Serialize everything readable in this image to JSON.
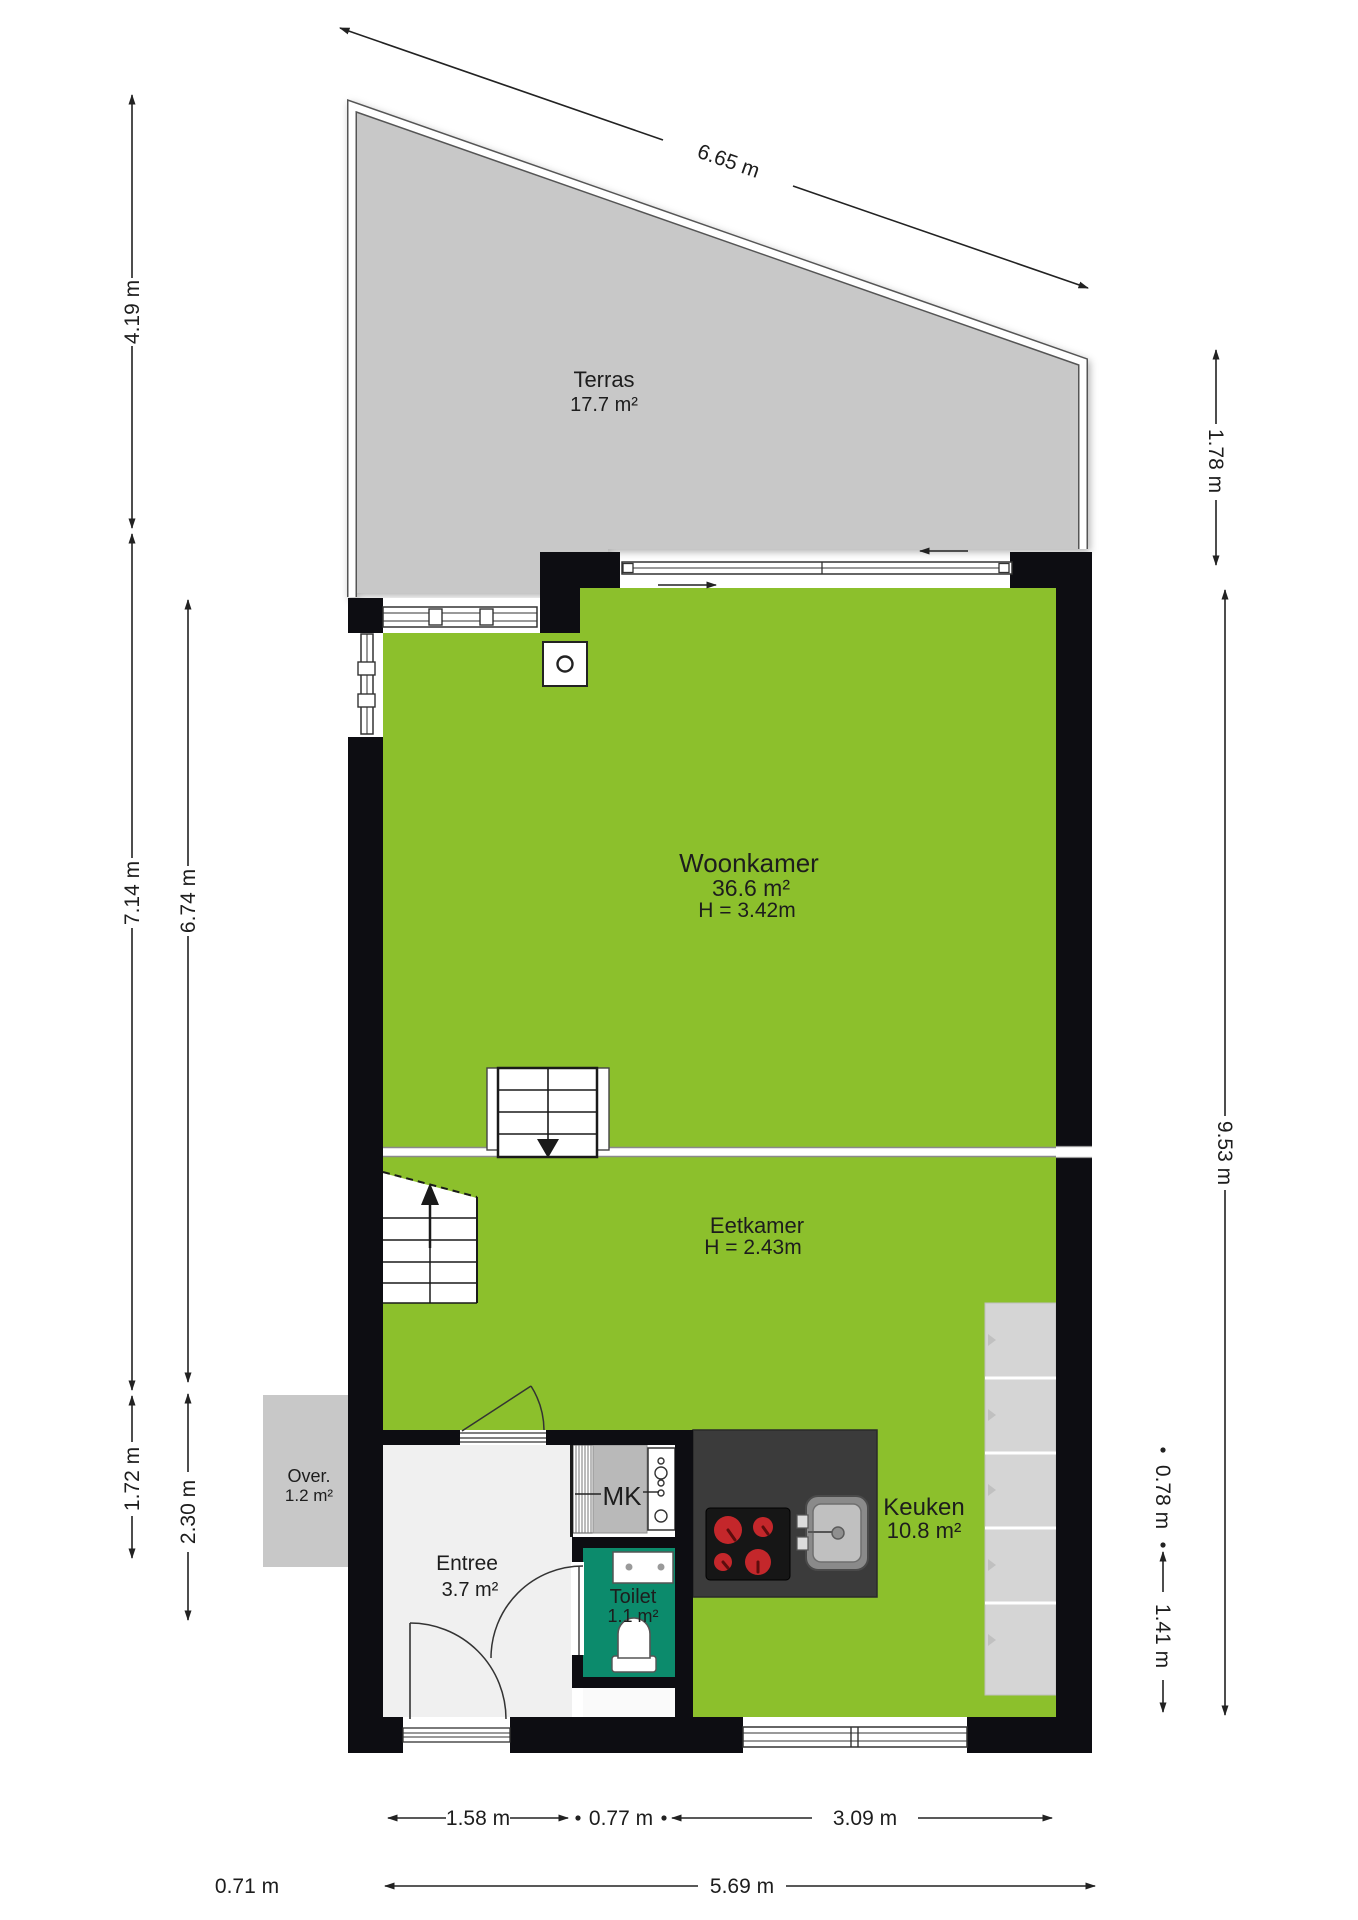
{
  "plan_title": "Floor plan ground floor",
  "colors": {
    "floor_green": "#8cc02c",
    "terrace_gray": "#c8c8c8",
    "wall": "#0d0d12",
    "toilet_teal": "#0c8b6c",
    "counter_dark": "#3b3b3b",
    "burner_red": "#c4272b",
    "counter_light": "#d5d5d5",
    "mk_gray": "#b9b9b9",
    "entree_floor": "#f0f0f0",
    "dim_color": "#222222"
  },
  "rooms": {
    "terras": {
      "name": "Terras",
      "area": "17.7 m²"
    },
    "woonkamer": {
      "name": "Woonkamer",
      "area": "36.6 m²",
      "height": "H = 3.42m"
    },
    "eetkamer": {
      "name": "Eetkamer",
      "height": "H = 2.43m"
    },
    "keuken": {
      "name": "Keuken",
      "area": "10.8 m²"
    },
    "entree": {
      "name": "Entree",
      "area": "3.7 m²"
    },
    "toilet": {
      "name": "Toilet",
      "area": "1.1 m²"
    },
    "over": {
      "name": "Over.",
      "area": "1.2 m²"
    },
    "mk": {
      "name": "MK"
    }
  },
  "dimensions": {
    "top": "6.65 m",
    "left": [
      "4.19 m",
      "7.14 m",
      "6.74 m",
      "1.72 m",
      "2.30 m"
    ],
    "right": [
      "1.78 m",
      "9.53 m",
      "0.78 m",
      "1.41 m"
    ],
    "bottom_row1": [
      "1.58 m",
      "0.77 m",
      "3.09 m"
    ],
    "bottom_row2": [
      "0.71 m",
      "5.69 m"
    ]
  }
}
